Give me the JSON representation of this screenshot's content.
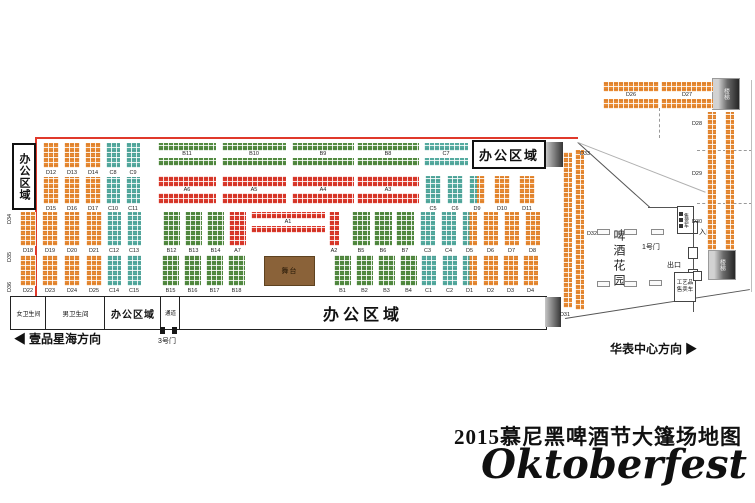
{
  "title": {
    "line1": "2015慕尼黑啤酒节大篷场地图",
    "line2": "Oktoberfest"
  },
  "colors": {
    "A": "#dc392b",
    "B": "#538b41",
    "C": "#55aba0",
    "D": "#e88a33",
    "stage": "#8a6239",
    "wall": "#e0392b"
  },
  "labels": {
    "office": "办公区域",
    "women": "女卫生间",
    "men": "男卫生间",
    "passage": "通道",
    "gate1": "1号门",
    "gate3": "3号门",
    "entrance": "入口",
    "exit": "出口",
    "stairs": "楼梯",
    "beer_garden": "啤酒花园",
    "stage": "舞台",
    "vendor_cart": "售货车",
    "craft_cart": "工艺品售卖车",
    "dir_left": "壹品星海方向",
    "dir_right": "华表中心方向",
    "arrow_left": "◀",
    "arrow_right": "▶"
  },
  "map": {
    "blocks": [
      [
        "D12",
        43,
        143,
        16,
        25,
        "D",
        "col"
      ],
      [
        "D13",
        64,
        143,
        16,
        25,
        "D",
        "col"
      ],
      [
        "D14",
        85,
        143,
        16,
        25,
        "D",
        "col"
      ],
      [
        "C8",
        106,
        143,
        14,
        25,
        "C",
        "col"
      ],
      [
        "C9",
        126,
        143,
        14,
        25,
        "C",
        "col"
      ],
      [
        "B11",
        158,
        143,
        58,
        23,
        "B",
        "band"
      ],
      [
        "B10",
        222,
        143,
        64,
        23,
        "B",
        "band"
      ],
      [
        "B9",
        292,
        143,
        62,
        23,
        "B",
        "band"
      ],
      [
        "B8",
        357,
        143,
        62,
        23,
        "B",
        "band"
      ],
      [
        "C7",
        424,
        143,
        44,
        23,
        "C",
        "band"
      ],
      [
        "D15",
        43,
        177,
        16,
        27,
        "D",
        "col"
      ],
      [
        "D16",
        64,
        177,
        16,
        27,
        "D",
        "col"
      ],
      [
        "D17",
        85,
        177,
        16,
        27,
        "D",
        "col"
      ],
      [
        "C10",
        106,
        177,
        14,
        27,
        "C",
        "col"
      ],
      [
        "C11",
        126,
        177,
        14,
        27,
        "C",
        "col"
      ],
      [
        "A6",
        158,
        176,
        58,
        28,
        "A",
        "band"
      ],
      [
        "A5",
        222,
        176,
        64,
        28,
        "A",
        "band"
      ],
      [
        "A4",
        292,
        176,
        62,
        28,
        "A",
        "band"
      ],
      [
        "A3",
        357,
        176,
        62,
        28,
        "A",
        "band"
      ],
      [
        "C5",
        425,
        176,
        16,
        28,
        "C",
        "col"
      ],
      [
        "C6",
        447,
        176,
        16,
        28,
        "C",
        "col"
      ],
      [
        "D9",
        469,
        176,
        16,
        28,
        "S",
        "col"
      ],
      [
        "D10",
        494,
        176,
        16,
        28,
        "D",
        "col"
      ],
      [
        "D11",
        519,
        176,
        16,
        28,
        "D",
        "col"
      ],
      [
        "D18",
        20,
        212,
        16,
        34,
        "D",
        "col"
      ],
      [
        "D19",
        42,
        212,
        16,
        34,
        "D",
        "col"
      ],
      [
        "D20",
        64,
        212,
        16,
        34,
        "D",
        "col"
      ],
      [
        "D21",
        86,
        212,
        16,
        34,
        "D",
        "col"
      ],
      [
        "C12",
        107,
        212,
        14,
        34,
        "C",
        "col"
      ],
      [
        "C13",
        127,
        212,
        14,
        34,
        "C",
        "col"
      ],
      [
        "B12",
        163,
        212,
        17,
        34,
        "B",
        "col"
      ],
      [
        "B13",
        185,
        212,
        17,
        34,
        "B",
        "col"
      ],
      [
        "B14",
        207,
        212,
        17,
        34,
        "B",
        "col"
      ],
      [
        "A7",
        229,
        212,
        17,
        34,
        "A",
        "col"
      ],
      [
        "A1",
        251,
        212,
        74,
        21,
        "A",
        "band"
      ],
      [
        "A2",
        329,
        212,
        10,
        34,
        "A",
        "col"
      ],
      [
        "B5",
        352,
        212,
        18,
        34,
        "B",
        "col"
      ],
      [
        "B6",
        374,
        212,
        18,
        34,
        "B",
        "col"
      ],
      [
        "B7",
        396,
        212,
        18,
        34,
        "B",
        "col"
      ],
      [
        "C3",
        420,
        212,
        15,
        34,
        "C",
        "col"
      ],
      [
        "C4",
        441,
        212,
        15,
        34,
        "C",
        "col"
      ],
      [
        "D5",
        462,
        212,
        15,
        34,
        "S",
        "col"
      ],
      [
        "D6",
        483,
        212,
        15,
        34,
        "D",
        "col"
      ],
      [
        "D7",
        504,
        212,
        15,
        34,
        "D",
        "col"
      ],
      [
        "D8",
        525,
        212,
        15,
        34,
        "D",
        "col"
      ],
      [
        "D22",
        20,
        255,
        16,
        31,
        "D",
        "col"
      ],
      [
        "D23",
        42,
        255,
        16,
        31,
        "D",
        "col"
      ],
      [
        "D24",
        64,
        255,
        16,
        31,
        "D",
        "col"
      ],
      [
        "D25",
        86,
        255,
        16,
        31,
        "D",
        "col"
      ],
      [
        "C14",
        107,
        255,
        14,
        31,
        "C",
        "col"
      ],
      [
        "C15",
        127,
        255,
        14,
        31,
        "C",
        "col"
      ],
      [
        "B15",
        162,
        255,
        17,
        31,
        "B",
        "col"
      ],
      [
        "B16",
        184,
        255,
        17,
        31,
        "B",
        "col"
      ],
      [
        "B17",
        206,
        255,
        17,
        31,
        "B",
        "col"
      ],
      [
        "B18",
        228,
        255,
        17,
        31,
        "B",
        "col"
      ],
      [
        "舞台",
        264,
        256,
        49,
        28,
        "stage",
        "stage"
      ],
      [
        "B1",
        334,
        255,
        17,
        31,
        "B",
        "col"
      ],
      [
        "B2",
        356,
        255,
        17,
        31,
        "B",
        "col"
      ],
      [
        "B3",
        378,
        255,
        17,
        31,
        "B",
        "col"
      ],
      [
        "B4",
        400,
        255,
        17,
        31,
        "B",
        "col"
      ],
      [
        "C1",
        421,
        255,
        15,
        31,
        "C",
        "col"
      ],
      [
        "C2",
        442,
        255,
        15,
        31,
        "C",
        "col"
      ],
      [
        "D1",
        462,
        255,
        15,
        31,
        "S",
        "col"
      ],
      [
        "D2",
        483,
        255,
        15,
        31,
        "D",
        "col"
      ],
      [
        "D3",
        503,
        255,
        15,
        31,
        "D",
        "col"
      ],
      [
        "D4",
        523,
        255,
        15,
        31,
        "D",
        "col"
      ],
      [
        "D26",
        603,
        82,
        56,
        27,
        "D",
        "band"
      ],
      [
        "D27",
        661,
        82,
        52,
        27,
        "D",
        "band"
      ],
      [
        "",
        707,
        112,
        9,
        138,
        "D",
        "strip"
      ],
      [
        "",
        725,
        112,
        9,
        138,
        "D",
        "strip"
      ],
      [
        "",
        563,
        152,
        9,
        156,
        "D",
        "strip"
      ],
      [
        "",
        575,
        150,
        9,
        160,
        "D",
        "strip"
      ]
    ],
    "free_labels": [
      {
        "t": "D33",
        "x": 578,
        "y": 151
      },
      {
        "t": "D32",
        "x": 585,
        "y": 231
      },
      {
        "t": "D31",
        "x": 558,
        "y": 312
      },
      {
        "t": "D28",
        "x": 690,
        "y": 121
      },
      {
        "t": "D29",
        "x": 690,
        "y": 171
      },
      {
        "t": "D30",
        "x": 690,
        "y": 219
      },
      {
        "t": "D34",
        "x": 7,
        "y": 226,
        "rot": 1
      },
      {
        "t": "D35",
        "x": 7,
        "y": 264,
        "rot": 1
      },
      {
        "t": "D36",
        "x": 7,
        "y": 294,
        "rot": 1
      }
    ],
    "tables": [
      [
        597,
        229
      ],
      [
        624,
        229
      ],
      [
        651,
        229
      ],
      [
        597,
        281
      ],
      [
        624,
        281
      ],
      [
        649,
        280
      ]
    ]
  }
}
